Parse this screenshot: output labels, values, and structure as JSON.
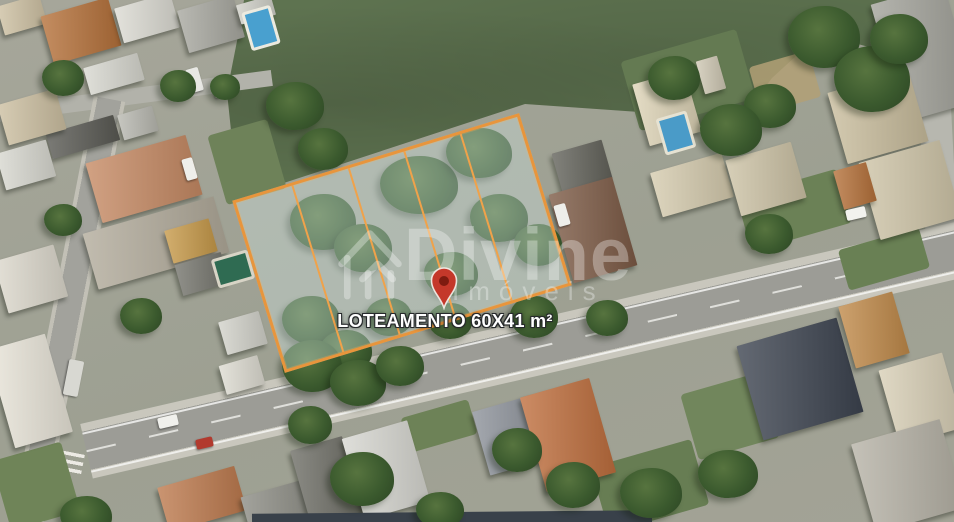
{
  "parcel": {
    "label": "LOTEAMENTO 60X41 m²",
    "lot_count": "5",
    "outline_color": "#E8953C"
  },
  "marker": {
    "color": "#C4382A",
    "inner_color": "#7E1B10",
    "stroke": "#F2EFEA"
  },
  "watermark": {
    "brand": "Divine",
    "subtitle": "Imóveis"
  }
}
